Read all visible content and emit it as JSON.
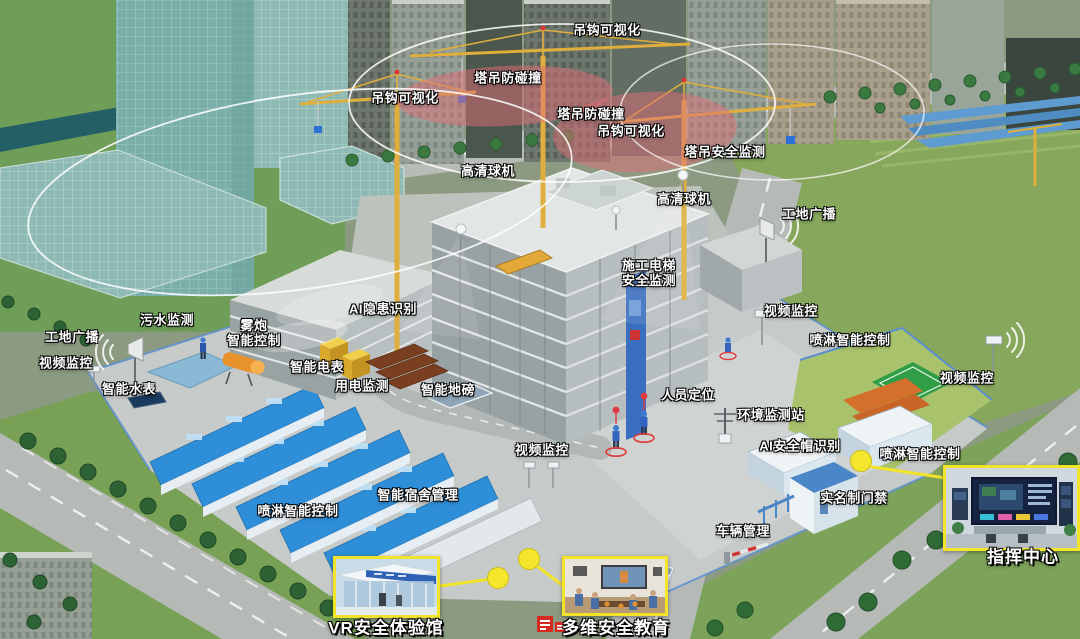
{
  "labels": [
    {
      "id": "hook-visualization-top",
      "text": "吊钩可视化",
      "x": 607,
      "y": 31
    },
    {
      "id": "tower-crane-anticollision-top",
      "text": "塔吊防碰撞",
      "x": 508,
      "y": 79
    },
    {
      "id": "hook-visualization-left",
      "text": "吊钩可视化",
      "x": 405,
      "y": 99
    },
    {
      "id": "tower-crane-anticollision-mid",
      "text": "塔吊防碰撞",
      "x": 591,
      "y": 115
    },
    {
      "id": "hook-visualization-mid",
      "text": "吊钩可视化",
      "x": 631,
      "y": 132
    },
    {
      "id": "hd-dome-camera-left",
      "text": "高清球机",
      "x": 488,
      "y": 172
    },
    {
      "id": "tower-crane-safety-monitor",
      "text": "塔吊安全监测",
      "x": 725,
      "y": 153
    },
    {
      "id": "hd-dome-camera-right",
      "text": "高清球机",
      "x": 684,
      "y": 200
    },
    {
      "id": "site-broadcast-right",
      "text": "工地广播",
      "x": 809,
      "y": 215
    },
    {
      "id": "construction-hoist-safety-monitor",
      "text": "施工电梯\n安全监测",
      "x": 649,
      "y": 274,
      "two": true
    },
    {
      "id": "sewage-monitor",
      "text": "污水监测",
      "x": 167,
      "y": 321
    },
    {
      "id": "ai-hazard-recognition",
      "text": "AI隐患识别",
      "x": 383,
      "y": 310
    },
    {
      "id": "site-broadcast-left",
      "text": "工地广播",
      "x": 72,
      "y": 338
    },
    {
      "id": "fog-cannon-smart-control",
      "text": "雾炮\n智能控制",
      "x": 254,
      "y": 334,
      "two": true
    },
    {
      "id": "video-surveillance-left",
      "text": "视频监控",
      "x": 66,
      "y": 364
    },
    {
      "id": "video-surveillance-midright",
      "text": "视频监控",
      "x": 791,
      "y": 312
    },
    {
      "id": "spray-smart-control-right",
      "text": "喷淋智能控制",
      "x": 850,
      "y": 341
    },
    {
      "id": "smart-electric-meter",
      "text": "智能电表",
      "x": 317,
      "y": 368
    },
    {
      "id": "smart-water-meter",
      "text": "智能水表",
      "x": 129,
      "y": 390
    },
    {
      "id": "power-usage-monitor",
      "text": "用电监测",
      "x": 362,
      "y": 387
    },
    {
      "id": "smart-weighbridge",
      "text": "智能地磅",
      "x": 448,
      "y": 391
    },
    {
      "id": "personnel-positioning",
      "text": "人员定位",
      "x": 688,
      "y": 396
    },
    {
      "id": "environment-monitor-station",
      "text": "环境监测站",
      "x": 771,
      "y": 416
    },
    {
      "id": "video-surveillance-right",
      "text": "视频监控",
      "x": 967,
      "y": 379
    },
    {
      "id": "video-surveillance-center",
      "text": "视频监控",
      "x": 542,
      "y": 451
    },
    {
      "id": "ai-helmet-recognition",
      "text": "AI安全帽识别",
      "x": 800,
      "y": 447
    },
    {
      "id": "spray-smart-control-bottom",
      "text": "喷淋智能控制",
      "x": 920,
      "y": 455
    },
    {
      "id": "smart-dormitory-management",
      "text": "智能宿舍管理",
      "x": 418,
      "y": 496
    },
    {
      "id": "real-name-access-control",
      "text": "实名制门禁",
      "x": 854,
      "y": 499
    },
    {
      "id": "spray-smart-control-left",
      "text": "喷淋智能控制",
      "x": 298,
      "y": 512
    },
    {
      "id": "vehicle-management",
      "text": "车辆管理",
      "x": 743,
      "y": 532
    }
  ],
  "insets": {
    "vr": {
      "caption": "VR安全体验馆"
    },
    "education": {
      "caption": "多维安全教育"
    },
    "command": {
      "caption": "指挥中心"
    }
  },
  "colors": {
    "label_text": "#ffffff",
    "label_outline": "#000000",
    "callout_yellow": "#f2e32b",
    "alert_pink": "rgba(225,110,120,0.5)",
    "crane_yellow": "#dfae3c",
    "dorm_roof_blue": "#2e8ed8",
    "grass_green": "#87a75c",
    "concrete_gray": "#c6cac8"
  }
}
